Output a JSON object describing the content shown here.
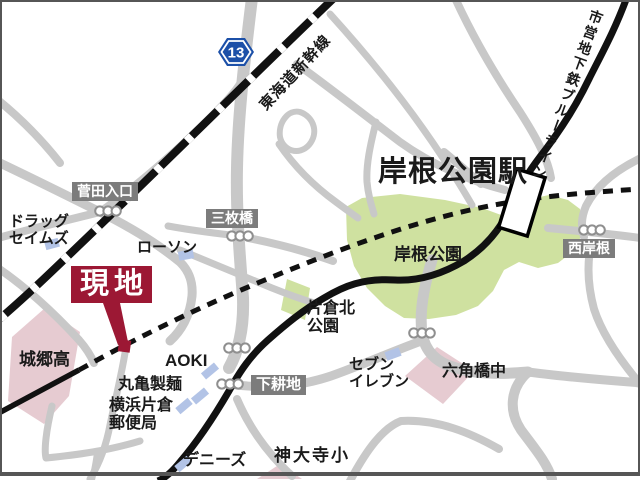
{
  "colors": {
    "road": "#c8c8c8",
    "park_green": "#cfe1a0",
    "school_pink": "#e6cbd1",
    "building_blue": "#b2c3e6",
    "label_box_gray": "#7c7c7c",
    "site_red": "#9c1834",
    "line_black": "#111111",
    "signal_stroke": "#8f8f8f",
    "route_shield_blue": "#1c50a8",
    "border_gray": "#565656"
  },
  "route_shield": {
    "number": "13",
    "x": 236,
    "y": 52
  },
  "station": {
    "rect": {
      "x": 507,
      "y": 172,
      "w": 30,
      "h": 61,
      "rot": 17,
      "cx": 522,
      "cy": 202
    }
  },
  "site_marker": {
    "tail_points": "103,303 120,303 128,342 118,345",
    "square": {
      "x": 118.5,
      "y": 340,
      "w": 12,
      "h": 12,
      "rot": 8,
      "cx": 124.5,
      "cy": 346
    }
  },
  "geometry": {
    "parks": [
      {
        "name": "park-kishine",
        "points": "346,207 362,198 400,194 445,200 482,208 512,219 526,200 549,195 568,200 580,209 584,229 575,250 558,263 538,268 519,262 504,270 493,291 478,306 456,315 429,319 404,318 385,306 367,288 354,266 347,240"
      },
      {
        "name": "park-katakura-kita",
        "points": "287,279 310,288 305,320 281,310"
      }
    ],
    "schools": [
      {
        "name": "school-shirosato-high",
        "points": "45,308 80,332 69,396 44,424 8,401 12,337"
      },
      {
        "name": "school-rokkakubashi-jhs",
        "points": "437,347 474,371 443,404 405,376"
      },
      {
        "name": "school-kandaiji-elem",
        "points": "280,464 302,479 257,479"
      }
    ],
    "roads": [
      {
        "name": "road-route13",
        "w": 12,
        "d": "M252,-2 C245,55 238,115 237,168 C236,214 240,258 243,298 C244,330 238,352 229,368"
      },
      {
        "name": "road-sugeta-west",
        "w": 9,
        "d": "M-2,162 C40,182 70,197 100,212 C132,228 158,244 180,262 C190,272 193,283 192,296 C190,316 181,331 170,341"
      },
      {
        "name": "road-sugeta-northeast",
        "w": 8,
        "d": "M100,212 C140,184 180,148 214,114 C227,101 235,92 240,84"
      },
      {
        "name": "road-sugeta-southwest",
        "w": 8,
        "d": "M-2,238 C35,228 68,220 100,212"
      },
      {
        "name": "road-upper-mid-to-station",
        "w": 8,
        "d": "M297,64 C330,88 366,116 400,142 C432,165 470,181 505,190"
      },
      {
        "name": "road-upper-branch",
        "w": 7,
        "d": "M376,122 C370,146 366,165 367,182 C368,194 371,204 374,214"
      },
      {
        "name": "road-loop",
        "w": 6,
        "d": "M300,112 C314,117 319,133 309,145 C299,156 283,151 280,137 C278,123 288,109 300,112"
      },
      {
        "name": "road-rail-side",
        "w": 7,
        "d": "M279,144 C294,166 314,186 336,202 C344,208 351,213 358,218"
      },
      {
        "name": "road-sanmaibashi-east",
        "w": 8,
        "d": "M248,238 C278,244 305,251 333,261"
      },
      {
        "name": "road-sanmaibashi-west",
        "w": 7,
        "d": "M168,226 C195,231 220,234 248,237"
      },
      {
        "name": "road-park-south",
        "w": 11,
        "d": "M432,260 C424,286 419,311 422,333 C425,352 437,363 456,368 C479,375 506,374 528,372"
      },
      {
        "name": "road-rokkaku-south",
        "w": 10,
        "d": "M528,372 C509,389 509,412 521,430 C536,450 547,463 552,479"
      },
      {
        "name": "road-rokkaku-east",
        "w": 9,
        "d": "M528,372 C566,377 603,380 642,383"
      },
      {
        "name": "road-seven-eleven",
        "w": 9,
        "d": "M230,384 C268,390 301,386 331,376 C362,365 396,350 424,340"
      },
      {
        "name": "road-bottom-left-diag",
        "w": 8,
        "d": "M237,399 C249,427 266,452 292,476"
      },
      {
        "name": "road-kandaiji-arc",
        "w": 8,
        "d": "M350,481 C367,449 383,428 401,421 C438,419 471,433 499,449"
      },
      {
        "name": "road-post-office-block",
        "w": 7,
        "d": "M52,406 C46,431 44,450 46,458 C76,455 107,451 140,441"
      },
      {
        "name": "road-post-office-south",
        "w": 6,
        "d": "M97,452 C96,462 94,471 92,480"
      },
      {
        "name": "road-site-south",
        "w": 7,
        "d": "M125,353 C121,377 115,401 110,425 C106,447 99,464 90,479"
      },
      {
        "name": "road-shirosato-top",
        "w": 8,
        "d": "M-2,268 C30,290 56,315 79,340 C86,348 91,356 94,363"
      },
      {
        "name": "road-station-west",
        "w": 8,
        "d": "M444,152 C456,162 468,172 481,184"
      },
      {
        "name": "road-top-right-curve",
        "w": 8,
        "d": "M641,158 C616,170 596,186 586,206 C581,218 581,227 584,237"
      },
      {
        "name": "road-nishikishine",
        "w": 8,
        "d": "M548,228 C580,231 610,234 641,238"
      },
      {
        "name": "road-right-mid-arc",
        "w": 8,
        "d": "M641,385 C619,359 602,334 594,309 C588,287 587,264 591,244"
      },
      {
        "name": "road-lawson-to-park",
        "w": 7,
        "d": "M180,250 C212,263 243,276 272,288 C287,294 301,299 314,303"
      },
      {
        "name": "road-top-455",
        "w": 8,
        "d": "M455,-2 C472,35 495,75 520,112 C538,140 548,160 551,178"
      },
      {
        "name": "road-ne-diag",
        "w": 7,
        "d": "M330,14 C368,56 407,103 443,158 C456,178 465,193 472,205"
      },
      {
        "name": "road-corner-topleft",
        "w": 8,
        "d": "M-2,100 C20,118 42,140 60,163"
      }
    ],
    "shinkansen": {
      "d": "M336,-4 C246,82 156,172 70,254 C46,277 22,300 -4,322",
      "w": 8,
      "white_dash": "7 36"
    },
    "main_black_line": {
      "w": 7,
      "d": "M627,-3 C615,30 601,55 589,79 C576,106 561,129 546,149 C532,167 523,180 516,196 C505,221 492,243 464,261 C437,277 414,281 395,280 C363,278 344,286 324,298 C303,310 285,325 268,340 C251,355 240,371 229,391 C215,415 198,441 180,462 C172,472 165,478 158,481"
    },
    "subway_solid_segment": {
      "w": 5.5,
      "d": "M-3,414 L79,370"
    },
    "subway_dashed": {
      "w": 5,
      "dash": "10 8",
      "d": "M79,370 C140,336 200,307 260,282 C330,253 400,226 470,210 C520,199 560,194 641,189"
    },
    "buildings": [
      {
        "name": "building-drug-seims",
        "x": 52,
        "y": 244,
        "w": 14,
        "h": 9,
        "rot": -15
      },
      {
        "name": "building-lawson",
        "x": 186,
        "y": 255,
        "w": 15,
        "h": 9,
        "rot": -10
      },
      {
        "name": "building-aoki",
        "x": 210,
        "y": 371,
        "w": 17,
        "h": 8,
        "rot": -40
      },
      {
        "name": "building-marugame",
        "x": 200,
        "y": 396,
        "w": 17,
        "h": 8,
        "rot": -40
      },
      {
        "name": "building-post-office",
        "x": 184,
        "y": 406,
        "w": 16,
        "h": 8,
        "rot": -40
      },
      {
        "name": "building-dennys",
        "x": 183,
        "y": 464,
        "w": 16,
        "h": 8,
        "rot": -40
      },
      {
        "name": "building-seven-eleven",
        "x": 393,
        "y": 354,
        "w": 15,
        "h": 9,
        "rot": -20
      }
    ],
    "signals": [
      {
        "name": "signal-sugeta-iriguchi",
        "x": 108,
        "y": 211
      },
      {
        "name": "signal-sanmaibashi",
        "x": 240,
        "y": 236
      },
      {
        "name": "signal-aoki-crossing",
        "x": 237,
        "y": 348
      },
      {
        "name": "signal-shimokouchi",
        "x": 230,
        "y": 384
      },
      {
        "name": "signal-kishine-park-south",
        "x": 422,
        "y": 333
      },
      {
        "name": "signal-nishikishine",
        "x": 592,
        "y": 230
      }
    ]
  },
  "labels": [
    {
      "name": "label-sugeta-iriguchi",
      "cls": "box",
      "text": "菅田入口",
      "x": 72,
      "y": 182,
      "fs": 14
    },
    {
      "name": "label-sanmaibashi",
      "cls": "box",
      "text": "三枚橋",
      "x": 206,
      "y": 209,
      "fs": 14
    },
    {
      "name": "label-shimokouchi",
      "cls": "box",
      "text": "下耕地",
      "x": 251,
      "y": 375,
      "fs": 15
    },
    {
      "name": "label-nishikishine",
      "cls": "box",
      "text": "西岸根",
      "x": 563,
      "y": 239,
      "fs": 14
    },
    {
      "name": "label-drug-seims",
      "text": "ドラッグ\nセイムズ",
      "x": 9,
      "y": 214,
      "fs": 15
    },
    {
      "name": "label-lawson",
      "text": "ローソン",
      "x": 137,
      "y": 240,
      "fs": 15
    },
    {
      "name": "label-shirosato-high",
      "text": "城郷高",
      "x": 19,
      "y": 351,
      "fs": 17
    },
    {
      "name": "label-aoki",
      "text": "AOKI",
      "x": 165,
      "y": 352,
      "fs": 17,
      "fw": 700
    },
    {
      "name": "label-marugame-seimen",
      "text": "丸亀製麺",
      "x": 118,
      "y": 376,
      "fs": 16
    },
    {
      "name": "label-yokohama-katakura-post",
      "text": "横浜片倉\n郵便局",
      "x": 109,
      "y": 397,
      "fs": 16
    },
    {
      "name": "label-dennys",
      "text": "デニーズ",
      "x": 183,
      "y": 452,
      "fs": 16
    },
    {
      "name": "label-kandaiji-elem",
      "text": "神大寺小",
      "x": 274,
      "y": 447,
      "fs": 17,
      "ls": 2
    },
    {
      "name": "label-seven-eleven",
      "text": "セブン\nイレブン",
      "x": 349,
      "y": 357,
      "fs": 15
    },
    {
      "name": "label-rokkakubashi-jhs",
      "text": "六角橋中",
      "x": 442,
      "y": 363,
      "fs": 16
    },
    {
      "name": "label-katakura-kita-park",
      "text": "片倉北\n公園",
      "x": 307,
      "y": 300,
      "fs": 16
    },
    {
      "name": "label-kishine-park",
      "text": "岸根公園",
      "x": 394,
      "y": 246,
      "fs": 17
    },
    {
      "name": "label-kishine-koen-station",
      "cls": "big",
      "text": "岸根公園駅",
      "x": 378,
      "y": 157,
      "fs": 29,
      "ls": 1
    },
    {
      "name": "label-site",
      "cls": "site",
      "text": "現地",
      "x": 71,
      "y": 266
    },
    {
      "name": "label-tokaido-shinkansen",
      "text": "東海道新幹線",
      "x": 241,
      "y": 65,
      "fs": 15,
      "rot": -47,
      "w": 110,
      "ls": 1,
      "center": true
    },
    {
      "name": "label-subway-blue-line",
      "cls": "vert",
      "text": "市営地下鉄ブルーライン",
      "x": 590,
      "y": 10,
      "fs": 14,
      "rot": 20,
      "ls": 2.5
    }
  ]
}
